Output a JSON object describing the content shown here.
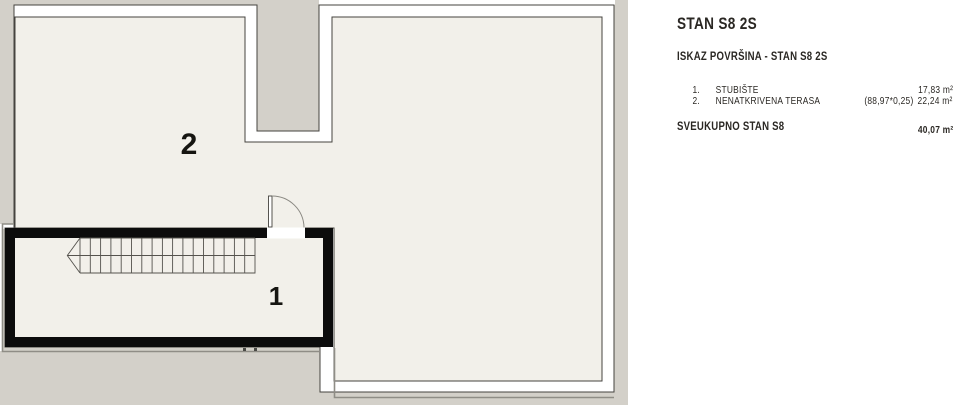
{
  "colors": {
    "canvas": "#d3d0c9",
    "interior": "#f2f0ea",
    "wall_line": "#45433f",
    "black_wall": "#0c0c0c",
    "offset_line": "#8f8d86",
    "text": "#2a2723"
  },
  "plan": {
    "labels": [
      {
        "id": "terrace",
        "text": "2"
      },
      {
        "id": "staircase",
        "text": "1"
      }
    ]
  },
  "panel": {
    "title": "STAN S8 2S",
    "subtitle": "ISKAZ POVRŠINA - STAN S8 2S",
    "rows": [
      {
        "num": "1.",
        "name": "STUBIŠTE",
        "calc": "",
        "value": "17,83 m²"
      },
      {
        "num": "2.",
        "name": "NENATKRIVENA TERASA",
        "calc": "(88,97*0,25)",
        "value": "22,24 m²"
      }
    ],
    "total_label": "SVEUKUPNO STAN S8",
    "total_value": "40,07 m²"
  }
}
